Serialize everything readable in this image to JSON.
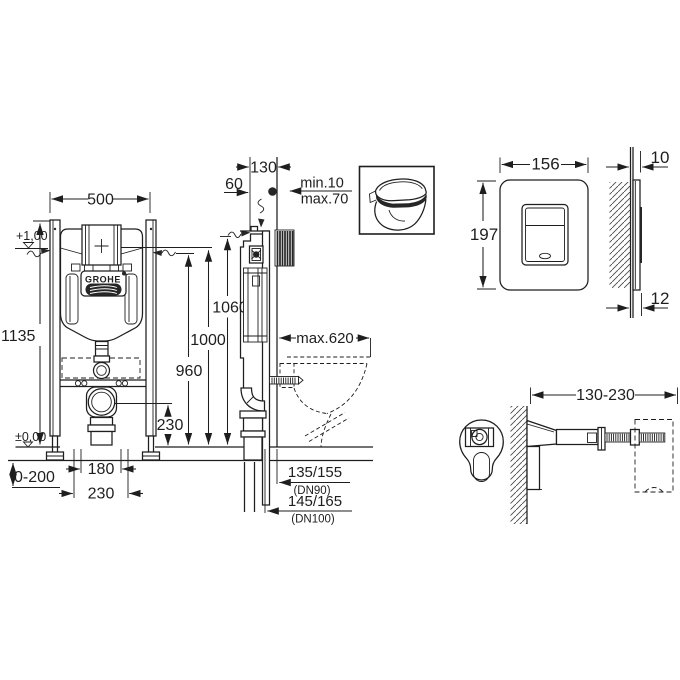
{
  "colors": {
    "background": "#ffffff",
    "line": "#1e1e1e",
    "dark_fill": "#262626"
  },
  "front_view": {
    "dim_width": "500",
    "dim_total_height": "1135",
    "level_upper": "+1,00",
    "level_floor": "±0,00",
    "dim_floor_range": "0-200",
    "dim_h1": "1060",
    "dim_h2": "1000",
    "dim_h3": "960",
    "dim_drain_height": "230",
    "dim_outlet_width": "180",
    "dim_outlet_spacing": "230",
    "brand": "GROHE"
  },
  "side_view": {
    "dim_depth": "130",
    "dim_top_offset": "60",
    "wall_min": "min.10",
    "wall_max": "max.70",
    "dim_bowl_depth": "max.620",
    "drain_dn90": "135/155",
    "dn90": "(DN90)",
    "drain_dn100": "145/165",
    "dn100": "(DN100)"
  },
  "flush_plate": {
    "dim_width": "156",
    "dim_height": "197",
    "dim_depth_top": "10",
    "dim_depth_bottom": "12"
  },
  "wall_bracket": {
    "dim_range": "130-230"
  }
}
